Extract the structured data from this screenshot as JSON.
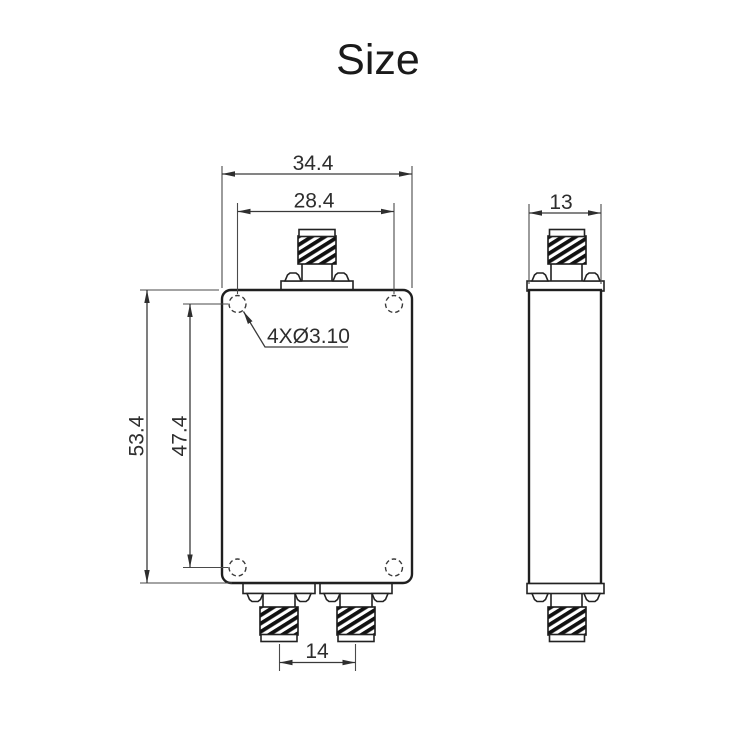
{
  "title": "Size",
  "front_view": {
    "overall_width": "34.4",
    "hole_spacing_horizontal": "28.4",
    "overall_height": "53.4",
    "hole_spacing_vertical": "47.4",
    "connector_spacing": "14",
    "hole_callout": "4XØ3.10"
  },
  "side_view": {
    "overall_depth": "13"
  },
  "colors": {
    "ink": "#1a1a1a",
    "dim_line": "#3a3a3a",
    "background": "#ffffff"
  }
}
